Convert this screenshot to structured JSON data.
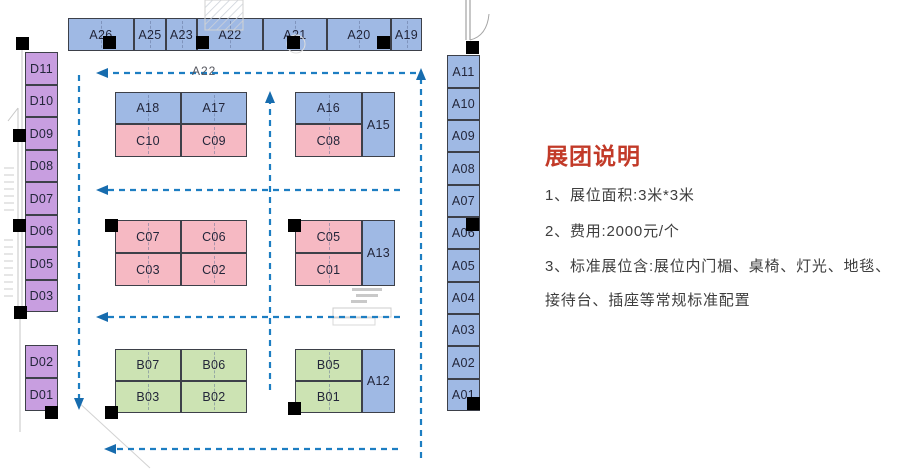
{
  "panel": {
    "title": "展团说明",
    "items": [
      "1、展位面积:3米*3米",
      "2、费用:2000元/个",
      "3、标准展位含:展位内门楣、桌椅、灯光、地毯、",
      "接待台、插座等常规标准配置"
    ]
  },
  "flow_label": "A22",
  "colors": {
    "blue": "#9fb9e4",
    "purple": "#c89ee0",
    "pink": "#f6b9c3",
    "green": "#cce3b3",
    "arrow": "#1d7ec2",
    "arrow_head": "#176cae",
    "title_red": "#c23a28",
    "pillar": "#000000"
  },
  "booths": [
    {
      "id": "A26",
      "x": 68,
      "y": 18,
      "w": 66,
      "h": 33,
      "c": "blue",
      "cl": true
    },
    {
      "id": "A25",
      "x": 134,
      "y": 18,
      "w": 32,
      "h": 33,
      "c": "blue",
      "cl": true
    },
    {
      "id": "A23",
      "x": 166,
      "y": 18,
      "w": 31,
      "h": 33,
      "c": "blue",
      "cl": true
    },
    {
      "id": "A22",
      "x": 197,
      "y": 18,
      "w": 66,
      "h": 33,
      "c": "blue",
      "cl": true
    },
    {
      "id": "A21",
      "x": 263,
      "y": 18,
      "w": 64,
      "h": 33,
      "c": "blue",
      "cl": true
    },
    {
      "id": "A20",
      "x": 327,
      "y": 18,
      "w": 64,
      "h": 33,
      "c": "blue",
      "cl": true
    },
    {
      "id": "A19",
      "x": 391,
      "y": 18,
      "w": 31,
      "h": 33,
      "c": "blue",
      "cl": true
    },
    {
      "id": "D11",
      "x": 25,
      "y": 52,
      "w": 33,
      "h": 33,
      "c": "purple",
      "cl": false
    },
    {
      "id": "D10",
      "x": 25,
      "y": 85,
      "w": 33,
      "h": 32,
      "c": "purple",
      "cl": false
    },
    {
      "id": "D09",
      "x": 25,
      "y": 117,
      "w": 33,
      "h": 33,
      "c": "purple",
      "cl": false
    },
    {
      "id": "D08",
      "x": 25,
      "y": 150,
      "w": 33,
      "h": 32,
      "c": "purple",
      "cl": false
    },
    {
      "id": "D07",
      "x": 25,
      "y": 182,
      "w": 33,
      "h": 33,
      "c": "purple",
      "cl": false
    },
    {
      "id": "D06",
      "x": 25,
      "y": 215,
      "w": 33,
      "h": 32,
      "c": "purple",
      "cl": false
    },
    {
      "id": "D05",
      "x": 25,
      "y": 247,
      "w": 33,
      "h": 33,
      "c": "purple",
      "cl": false
    },
    {
      "id": "D03",
      "x": 25,
      "y": 280,
      "w": 33,
      "h": 32,
      "c": "purple",
      "cl": false
    },
    {
      "id": "D02",
      "x": 25,
      "y": 345,
      "w": 33,
      "h": 33,
      "c": "purple",
      "cl": false
    },
    {
      "id": "D01",
      "x": 25,
      "y": 378,
      "w": 33,
      "h": 33,
      "c": "purple",
      "cl": false
    },
    {
      "id": "A11",
      "x": 447,
      "y": 55,
      "w": 33,
      "h": 33,
      "c": "blue",
      "cl": false
    },
    {
      "id": "A10",
      "x": 447,
      "y": 88,
      "w": 33,
      "h": 32,
      "c": "blue",
      "cl": false
    },
    {
      "id": "A09",
      "x": 447,
      "y": 120,
      "w": 33,
      "h": 32,
      "c": "blue",
      "cl": false
    },
    {
      "id": "A08",
      "x": 447,
      "y": 152,
      "w": 33,
      "h": 33,
      "c": "blue",
      "cl": false
    },
    {
      "id": "A07",
      "x": 447,
      "y": 185,
      "w": 33,
      "h": 32,
      "c": "blue",
      "cl": false
    },
    {
      "id": "A06",
      "x": 447,
      "y": 217,
      "w": 33,
      "h": 32,
      "c": "blue",
      "cl": false
    },
    {
      "id": "A05",
      "x": 447,
      "y": 249,
      "w": 33,
      "h": 33,
      "c": "blue",
      "cl": false
    },
    {
      "id": "A04",
      "x": 447,
      "y": 282,
      "w": 33,
      "h": 32,
      "c": "blue",
      "cl": false
    },
    {
      "id": "A03",
      "x": 447,
      "y": 314,
      "w": 33,
      "h": 32,
      "c": "blue",
      "cl": false
    },
    {
      "id": "A02",
      "x": 447,
      "y": 346,
      "w": 33,
      "h": 33,
      "c": "blue",
      "cl": false
    },
    {
      "id": "A01",
      "x": 447,
      "y": 379,
      "w": 33,
      "h": 32,
      "c": "blue",
      "cl": false
    },
    {
      "id": "A18",
      "x": 115,
      "y": 92,
      "w": 66,
      "h": 32,
      "c": "blue",
      "cl": true
    },
    {
      "id": "A17",
      "x": 181,
      "y": 92,
      "w": 66,
      "h": 32,
      "c": "blue",
      "cl": true
    },
    {
      "id": "C10",
      "x": 115,
      "y": 124,
      "w": 66,
      "h": 33,
      "c": "pink",
      "cl": true
    },
    {
      "id": "C09",
      "x": 181,
      "y": 124,
      "w": 66,
      "h": 33,
      "c": "pink",
      "cl": true
    },
    {
      "id": "A16",
      "x": 295,
      "y": 92,
      "w": 67,
      "h": 32,
      "c": "blue",
      "cl": true
    },
    {
      "id": "C08",
      "x": 295,
      "y": 124,
      "w": 67,
      "h": 33,
      "c": "pink",
      "cl": true
    },
    {
      "id": "A15",
      "x": 362,
      "y": 92,
      "w": 33,
      "h": 65,
      "c": "blue",
      "cl": false
    },
    {
      "id": "C07",
      "x": 115,
      "y": 220,
      "w": 66,
      "h": 33,
      "c": "pink",
      "cl": true
    },
    {
      "id": "C06",
      "x": 181,
      "y": 220,
      "w": 66,
      "h": 33,
      "c": "pink",
      "cl": true
    },
    {
      "id": "C03",
      "x": 115,
      "y": 253,
      "w": 66,
      "h": 33,
      "c": "pink",
      "cl": true
    },
    {
      "id": "C02",
      "x": 181,
      "y": 253,
      "w": 66,
      "h": 33,
      "c": "pink",
      "cl": true
    },
    {
      "id": "C05",
      "x": 295,
      "y": 220,
      "w": 67,
      "h": 33,
      "c": "pink",
      "cl": true
    },
    {
      "id": "C01",
      "x": 295,
      "y": 253,
      "w": 67,
      "h": 33,
      "c": "pink",
      "cl": true
    },
    {
      "id": "A13",
      "x": 362,
      "y": 220,
      "w": 33,
      "h": 66,
      "c": "blue",
      "cl": false
    },
    {
      "id": "B07",
      "x": 115,
      "y": 349,
      "w": 66,
      "h": 32,
      "c": "green",
      "cl": true
    },
    {
      "id": "B06",
      "x": 181,
      "y": 349,
      "w": 66,
      "h": 32,
      "c": "green",
      "cl": true
    },
    {
      "id": "B03",
      "x": 115,
      "y": 381,
      "w": 66,
      "h": 32,
      "c": "green",
      "cl": true
    },
    {
      "id": "B02",
      "x": 181,
      "y": 381,
      "w": 66,
      "h": 32,
      "c": "green",
      "cl": true
    },
    {
      "id": "B05",
      "x": 295,
      "y": 349,
      "w": 67,
      "h": 32,
      "c": "green",
      "cl": true
    },
    {
      "id": "B01",
      "x": 295,
      "y": 381,
      "w": 67,
      "h": 32,
      "c": "green",
      "cl": true
    },
    {
      "id": "A12",
      "x": 362,
      "y": 349,
      "w": 33,
      "h": 64,
      "c": "blue",
      "cl": false
    }
  ],
  "pillars": [
    {
      "x": 103,
      "y": 36
    },
    {
      "x": 196,
      "y": 36
    },
    {
      "x": 287,
      "y": 36
    },
    {
      "x": 377,
      "y": 36
    },
    {
      "x": 16,
      "y": 37
    },
    {
      "x": 13,
      "y": 129
    },
    {
      "x": 13,
      "y": 219
    },
    {
      "x": 14,
      "y": 306
    },
    {
      "x": 45,
      "y": 406
    },
    {
      "x": 105,
      "y": 406
    },
    {
      "x": 105,
      "y": 219
    },
    {
      "x": 288,
      "y": 219
    },
    {
      "x": 288,
      "y": 402
    },
    {
      "x": 466,
      "y": 41
    },
    {
      "x": 466,
      "y": 218
    },
    {
      "x": 467,
      "y": 397
    }
  ],
  "arrows": [
    {
      "x1": 416,
      "y1": 73,
      "x2": 108,
      "y2": 73
    },
    {
      "x1": 400,
      "y1": 190,
      "x2": 108,
      "y2": 190
    },
    {
      "x1": 400,
      "y1": 317,
      "x2": 108,
      "y2": 317
    },
    {
      "x1": 398,
      "y1": 449,
      "x2": 116,
      "y2": 449
    },
    {
      "x1": 79,
      "y1": 75,
      "x2": 79,
      "y2": 398
    },
    {
      "x1": 270,
      "y1": 390,
      "x2": 270,
      "y2": 103
    },
    {
      "x1": 421,
      "y1": 458,
      "x2": 421,
      "y2": 80
    }
  ]
}
